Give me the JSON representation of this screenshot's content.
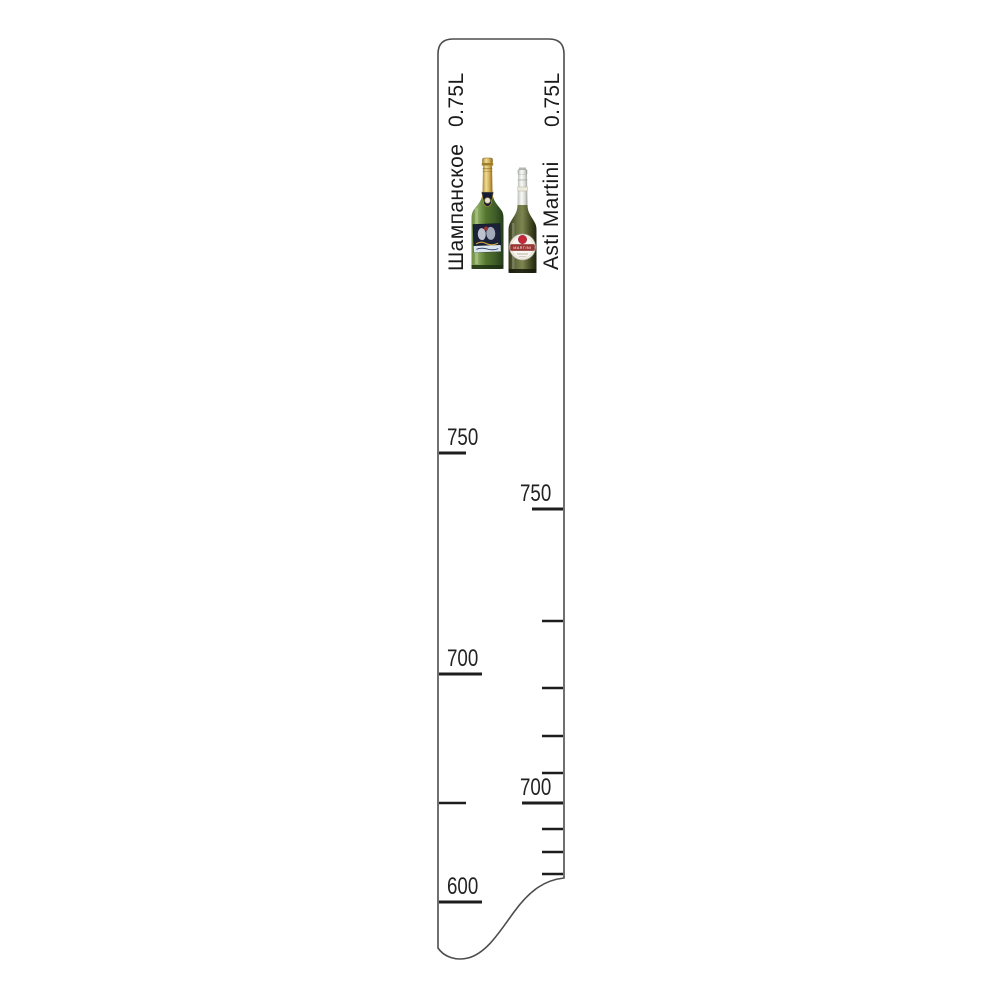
{
  "page": {
    "background": "#ffffff"
  },
  "ruler": {
    "fill": "#ffffff",
    "outline_color": "#4d4d4d",
    "tick_color": "#1d1d1d",
    "label_color": "#222222",
    "left_scale": {
      "name": "Шампанское",
      "volume": "0.75L",
      "side": "left",
      "edge_x": 439,
      "label_x": 447,
      "ticks": [
        {
          "y": 453,
          "len": 27,
          "label": "750"
        },
        {
          "y": 674,
          "len": 43,
          "label": "700"
        },
        {
          "y": 803,
          "len": 27,
          "label": "",
          "minor": true
        },
        {
          "y": 902,
          "len": 43,
          "label": "600"
        }
      ]
    },
    "right_scale": {
      "name": "Asti Martini",
      "volume": "0.75L",
      "side": "right",
      "edge_x": 563,
      "label_x": 520,
      "ticks": [
        {
          "y": 509,
          "len": 31,
          "label": "750"
        },
        {
          "y": 621,
          "len": 21,
          "label": "",
          "minor": true
        },
        {
          "y": 688,
          "len": 21,
          "label": "",
          "minor": true
        },
        {
          "y": 736,
          "len": 21,
          "label": "",
          "minor": true
        },
        {
          "y": 773,
          "len": 21,
          "label": "",
          "minor": true
        },
        {
          "y": 803,
          "len": 41,
          "label": "700"
        },
        {
          "y": 829,
          "len": 21,
          "label": "",
          "minor": true
        },
        {
          "y": 852,
          "len": 21,
          "label": "",
          "minor": true
        },
        {
          "y": 874,
          "len": 21,
          "label": "",
          "minor": true
        }
      ]
    }
  },
  "bottles": {
    "champagne": {
      "name": "champagne-bottle"
    },
    "martini": {
      "name": "asti-martini-bottle",
      "band_text": "MARTINI"
    }
  }
}
